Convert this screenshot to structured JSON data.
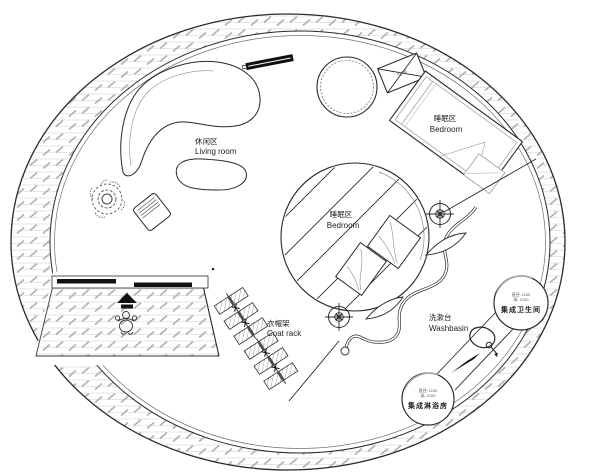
{
  "title": "circular-house-floor-plan",
  "labels": {
    "living_room": {
      "zh": "休闲区",
      "en": "Living room"
    },
    "bedroom_upper": {
      "zh": "睡眠区",
      "en": "Bedroom"
    },
    "bedroom_center": {
      "zh": "睡眠区",
      "en": "Bedroom"
    },
    "coat_rack": {
      "zh": "衣帽架",
      "en": "Coat rack"
    },
    "washbasin": {
      "zh": "洗漱台",
      "en": "Washbasin"
    }
  },
  "pods": {
    "bathroom": {
      "spec1": "直径: 1100",
      "spec2": "高: 2100",
      "name": "集成卫生间"
    },
    "shower": {
      "spec1": "直径: 1100",
      "spec2": "高: 2100",
      "name": "集成淋浴房"
    }
  },
  "equipment": {
    "ac_label": "空调"
  },
  "colors": {
    "line": "#2a2a2a",
    "hatch": "#b3b3b3",
    "hatch_bg_line": "#dedede",
    "light_line": "#999999",
    "bg": "#ffffff"
  }
}
